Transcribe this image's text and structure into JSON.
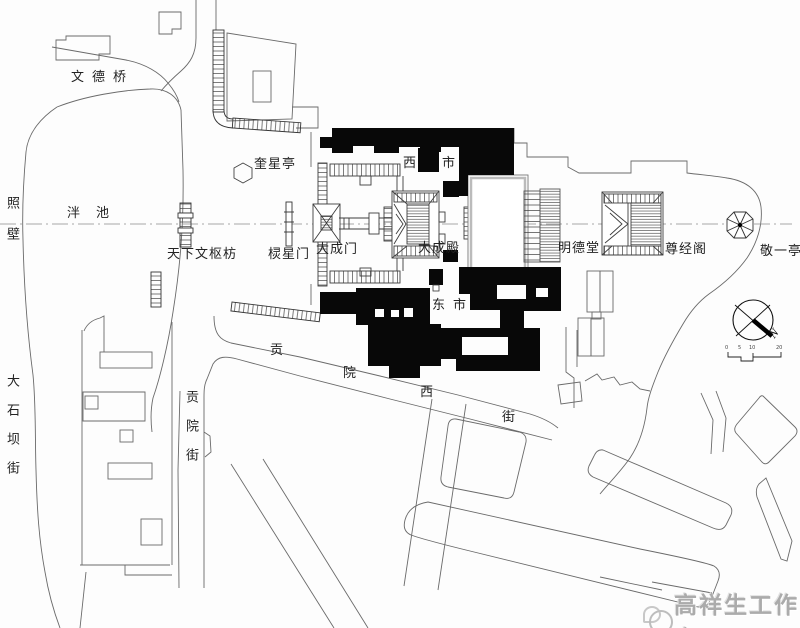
{
  "title_hint": "historic-site-plan",
  "labels": {
    "zhaobi": "照壁",
    "wendeqiao": "文德桥",
    "panchi": "泮池",
    "tianxia_wenshu_fang": "天下文枢枋",
    "kuixingting": "奎星亭",
    "lingxingmen": "棂星门",
    "dachengmen": "大成门",
    "dachengdian": "大成殿",
    "xishi": "西市",
    "dongshi": "东市",
    "mingdetang": "明德堂",
    "zunjingge": "尊经阁",
    "jingyiting": "敬一亭",
    "dashiba_street": "大石坝街",
    "gongyuan_street": "贡院街",
    "gongyuanxi_street": {
      "c1": "贡",
      "c2": "院",
      "c3": "西",
      "c4": "街"
    },
    "compass_n": "N",
    "scale": {
      "t0": "0",
      "t1": "5",
      "t2": "10",
      "t3": "20"
    },
    "watermark": "高祥生工作室"
  },
  "colors": {
    "paper": "#fdfdfd",
    "line": "#6a6a6a",
    "building_outline": "#3d3d3d",
    "building_fill_black": "#080808",
    "axis_line": "#8a8a8a",
    "watermark_gray": "#ababab"
  }
}
